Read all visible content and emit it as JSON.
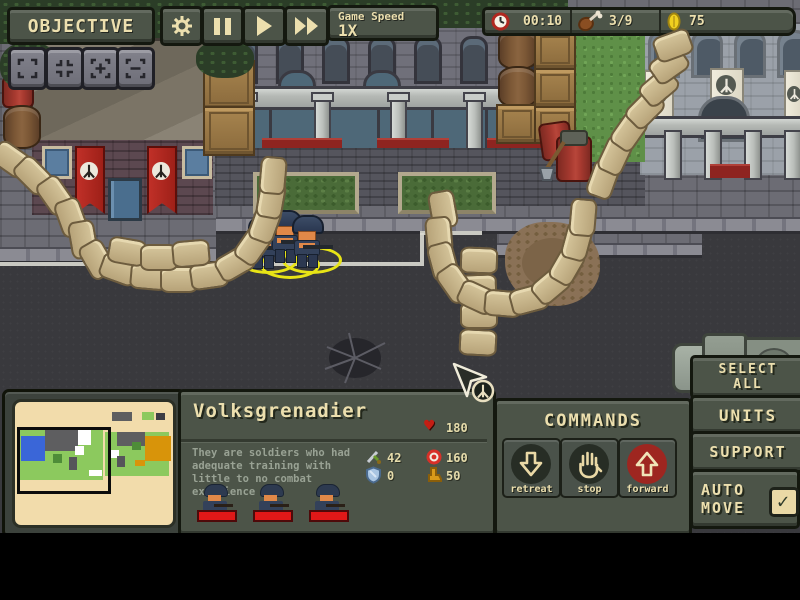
{
  "hud": {
    "objective": "OBJECTIVE",
    "game_speed_label": "Game Speed",
    "game_speed_value": "1X",
    "time": "00:10",
    "rations": "3/9",
    "gold": "75"
  },
  "unit_panel": {
    "name": "Volksgrenadier",
    "hp": "180",
    "description": "They are soldiers who had adequate training with little to no combat experience",
    "stats": [
      {
        "icon": "sword-icon",
        "value": "42"
      },
      {
        "icon": "target-icon",
        "value": "160"
      },
      {
        "icon": "shield-icon",
        "value": "0"
      },
      {
        "icon": "boot-icon",
        "value": "50"
      }
    ],
    "squad_size": 3
  },
  "commands": {
    "title": "COMMANDS",
    "buttons": [
      {
        "label": "retreat",
        "icon": "arrow-down-icon",
        "active": false
      },
      {
        "label": "stop",
        "icon": "hand-icon",
        "active": false
      },
      {
        "label": "forward",
        "icon": "arrow-up-icon",
        "active": true
      }
    ]
  },
  "side_panel": {
    "select_all": "SELECT ALL",
    "units": "UNITS",
    "support": "SUPPORT",
    "auto_move": "AUTO MOVE",
    "auto_move_checked": true,
    "check_mark": "✓"
  },
  "colors": {
    "panel": "#4c5448",
    "panel_border": "#14180f",
    "text_cream": "#ecdfae",
    "accent_red": "#9e2620",
    "health_red": "#e01818",
    "selection_yellow": "#e8e416",
    "banner_red": "#a82520",
    "banner_cream": "#eee9da",
    "coin_gold": "#f0d020",
    "grass": "#5f9048",
    "road": "#39393d",
    "minimap_bg": "#f2dcab"
  },
  "minimap": {
    "viewport": {
      "x": 2,
      "y": 25,
      "w": 88,
      "h": 61
    },
    "blocks": [
      {
        "x": 4,
        "y": 28,
        "w": 84,
        "h": 50,
        "color": "#8cc95e"
      },
      {
        "x": 90,
        "y": 30,
        "w": 64,
        "h": 44,
        "color": "#8cc95e"
      },
      {
        "x": 6,
        "y": 34,
        "w": 24,
        "h": 25,
        "color": "#3a66d8"
      },
      {
        "x": 30,
        "y": 28,
        "w": 33,
        "h": 21,
        "color": "#5e5e60"
      },
      {
        "x": 63,
        "y": 28,
        "w": 13,
        "h": 15,
        "color": "#ffffff"
      },
      {
        "x": 60,
        "y": 44,
        "w": 9,
        "h": 9,
        "color": "#ffffff"
      },
      {
        "x": 38,
        "y": 52,
        "w": 9,
        "h": 9,
        "color": "#4e8c38"
      },
      {
        "x": 54,
        "y": 55,
        "w": 8,
        "h": 13,
        "color": "#55555a"
      },
      {
        "x": 74,
        "y": 68,
        "w": 13,
        "h": 6,
        "color": "#ffffff"
      },
      {
        "x": 102,
        "y": 30,
        "w": 28,
        "h": 14,
        "color": "#5e5e60"
      },
      {
        "x": 130,
        "y": 34,
        "w": 26,
        "h": 25,
        "color": "#d8940a"
      },
      {
        "x": 95,
        "y": 48,
        "w": 9,
        "h": 8,
        "color": "#ffffff"
      },
      {
        "x": 102,
        "y": 54,
        "w": 8,
        "h": 11,
        "color": "#55555a"
      },
      {
        "x": 120,
        "y": 58,
        "w": 10,
        "h": 6,
        "color": "#d8940a"
      },
      {
        "x": 117,
        "y": 40,
        "w": 9,
        "h": 8,
        "color": "#4e8c38"
      },
      {
        "x": 97,
        "y": 10,
        "w": 20,
        "h": 9,
        "color": "#5e5e60"
      },
      {
        "x": 127,
        "y": 10,
        "w": 12,
        "h": 8,
        "color": "#8cc95e"
      },
      {
        "x": 141,
        "y": 11,
        "w": 9,
        "h": 7,
        "color": "#3d3d44"
      }
    ]
  }
}
